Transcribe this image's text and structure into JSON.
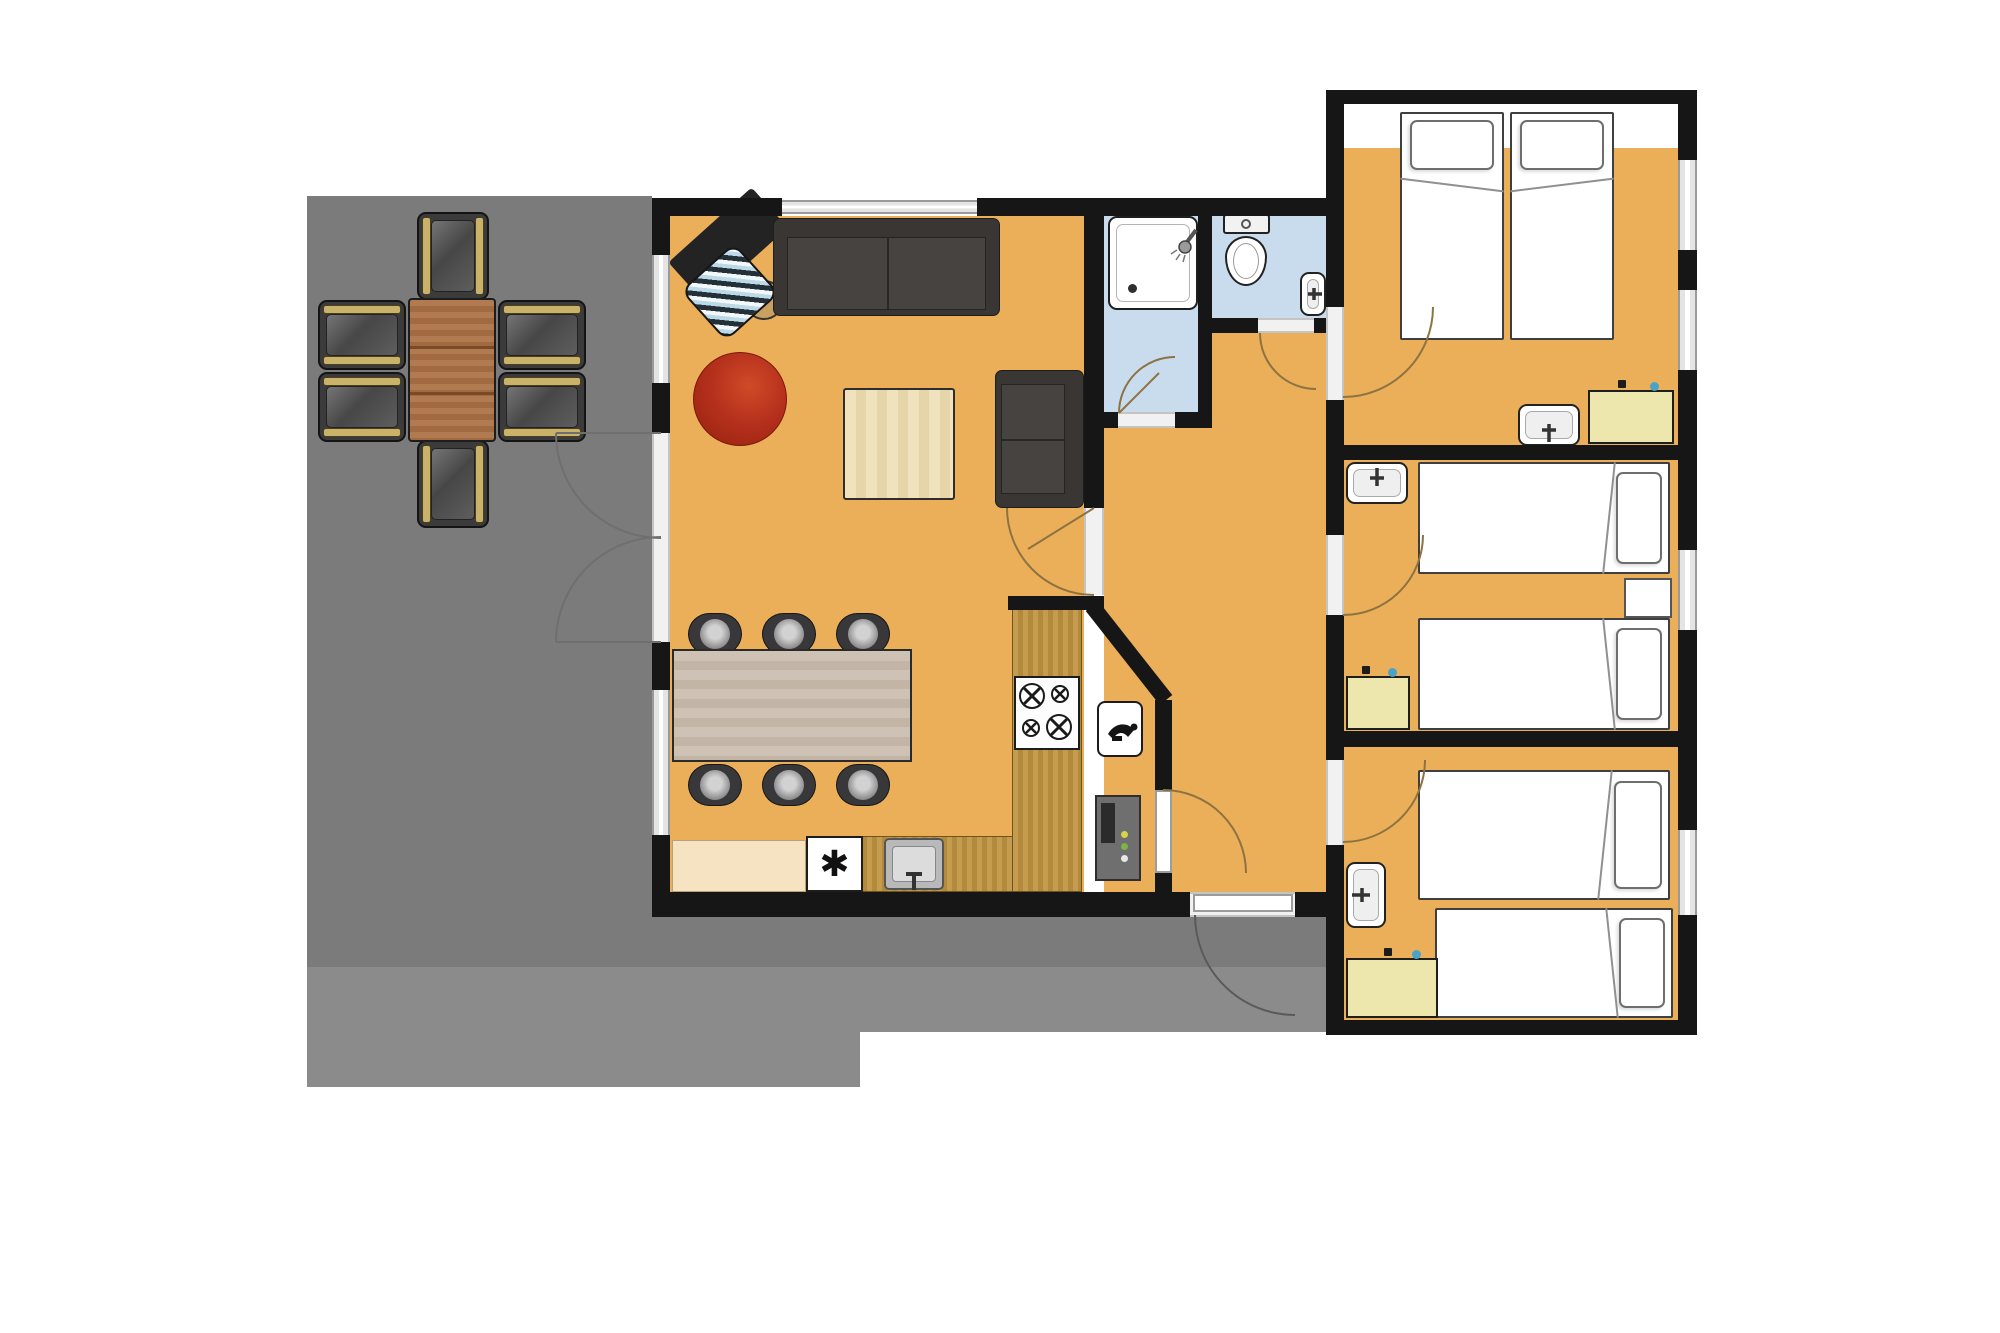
{
  "palette": {
    "floor": "#ECAF59",
    "terrace": "#7B7B7B",
    "terraceBand": "#8B8B8B",
    "wall": "#161616",
    "bath": "#C9DCEE",
    "glass": "#E4E4E4",
    "threshold": "#F1F1F1",
    "arc": "#8D7342",
    "arcOut": "#6F6F6F",
    "cabinet": "#EDE7AD",
    "wood": "#C49B4F",
    "woodDark": "#B38A3C",
    "cream": "#F5E3C2",
    "tableIn": "#CEC2B4",
    "tableInDark": "#C2B5A6",
    "tableOut": "#B27A50",
    "tableOutDark": "#A26A40",
    "sofa": "#393634",
    "sofaSeat": "#474340",
    "red": "#B5301C",
    "coffee": "#F0E2BD",
    "coffeeDark": "#E6D5A8",
    "stool": "#38383A",
    "outChair": "#3B3B3B",
    "armrest": "#C9B26A",
    "boiler": "#6F6F6F",
    "white": "#FFFFFF"
  },
  "glyphs": {
    "freezer": "✱"
  },
  "inventory": {
    "rooms": [
      "terrace",
      "living-room",
      "dining-area",
      "kitchen",
      "utility-closet",
      "hallway",
      "shower-room",
      "wc",
      "bedroom-double",
      "bedroom-twin-upper",
      "bedroom-twin-lower"
    ],
    "furniture": {
      "outdoor_chairs": 6,
      "outdoor_table": 1,
      "sofas": 2,
      "armchair_red": 1,
      "coffee_table": 1,
      "desk_with_chair": 1,
      "dining_stools": 6,
      "dining_table": 1,
      "kitchen_stove_burners": 4,
      "freezer": 1,
      "kitchen_sink": 1,
      "boiler": 1,
      "shower": 1,
      "toilet": 1,
      "wash_basins": 5,
      "single_beds": 6,
      "yellow_cabinets": 3,
      "windows": 11,
      "door_arcs": 9
    }
  }
}
